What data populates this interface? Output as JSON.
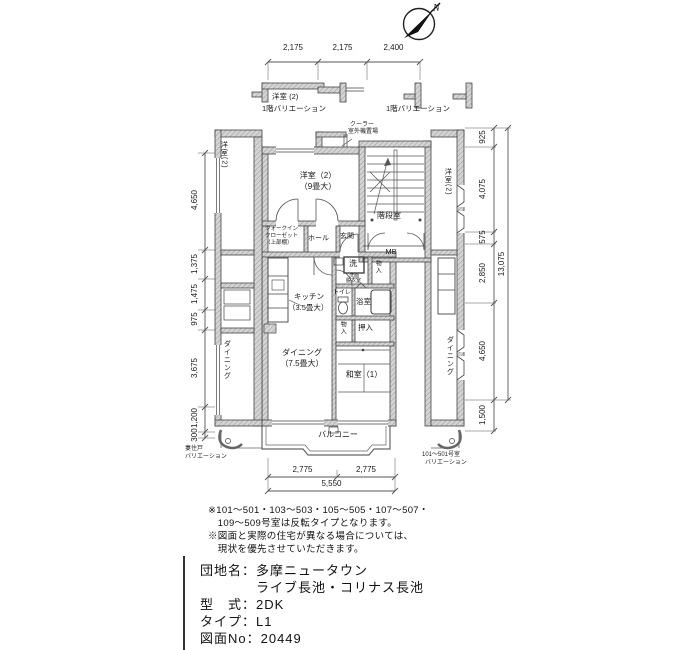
{
  "compass": {
    "north_label": "N"
  },
  "fragments": {
    "left_room": "洋室 (2)",
    "left_variation": "1階バリエーション",
    "right_variation": "1階バリエーション"
  },
  "ac_unit": {
    "line1": "クーラー",
    "line2": "室外機置場"
  },
  "rooms": {
    "bedroom2": "洋室（2）",
    "bedroom2_size": "（9畳大）",
    "stairwell": "階段室",
    "meter_box": "MB",
    "entrance": "玄関",
    "hall": "ホール",
    "wic_line1": "ウォークイン",
    "wic_line2": "クローゼット",
    "wic_line3": "（上部棚）",
    "washer": "洗",
    "washroom_line1": "洗面",
    "washroom_line2": "脱衣室",
    "storage1": "物入",
    "toilet": "トイレ",
    "bath": "浴室",
    "kitchen": "キッチン",
    "kitchen_size": "（3.5畳大）",
    "storage2": "物入",
    "oshiire": "押入",
    "dining": "ダイニング",
    "dining_size": "（7.5畳大）",
    "washitsu": "和室（1）",
    "balcony": "バルコニー"
  },
  "neighbors": {
    "left_bedroom": "洋室(2)",
    "left_dining": "ダイニング",
    "right_bedroom": "洋室(2)",
    "right_dining": "ダイニング",
    "left_note_line1": "妻住戸",
    "left_note_line2": "バリエーション",
    "right_note_line1": "101～501号室",
    "right_note_line2": "バリエーション"
  },
  "dimensions": {
    "top": [
      "2,175",
      "2,175",
      "2,400"
    ],
    "bottom": [
      "2,775",
      "2,775"
    ],
    "bottom_total": "5,550",
    "left": [
      "4,650",
      "1,375",
      "1,475",
      "975",
      "3,675",
      "1,200",
      "300"
    ],
    "right": [
      "925",
      "4,075",
      "575",
      "2,850",
      "4,650",
      "1,500"
    ],
    "right_total": "13,075"
  },
  "notes": [
    "※101～501・103～503・105～505・107～507・",
    "　109～509号室は反転タイプとなります。",
    "※図面と実際の住宅が異なる場合については、",
    "　現状を優先させていただきます。"
  ],
  "info": [
    "団地名：多摩ニュータウン",
    "　　　　ライブ長池・コリナス長池",
    "型　式：2DK",
    "タイプ：L1",
    "図面No：20449"
  ],
  "colors": {
    "wall_fill": "#d4d4d4",
    "wall_hatch": "#9a9a9a",
    "line": "#3c3c3c",
    "text": "#1a1a1a",
    "background": "#ffffff"
  }
}
